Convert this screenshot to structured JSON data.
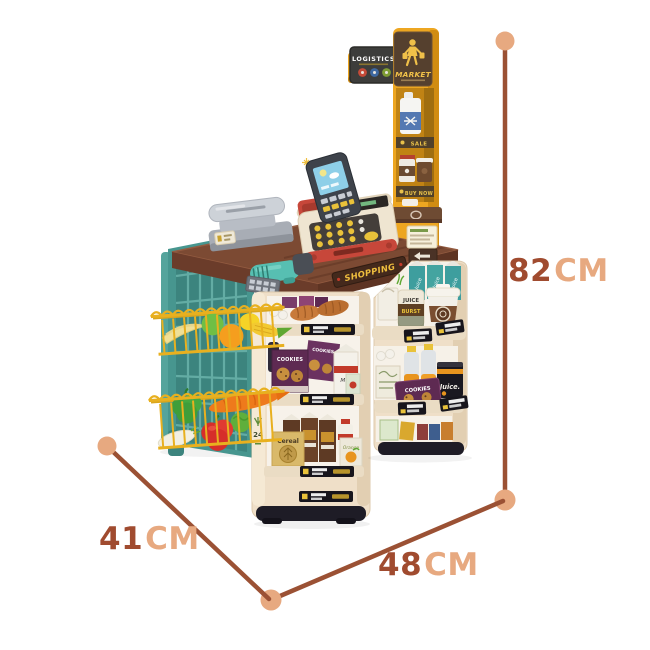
{
  "scene": {
    "type": "product-photo-with-dimension-annotations",
    "product_name": "toy-supermarket-checkout-playset",
    "background": "#ffffff"
  },
  "dimensions": {
    "height": {
      "value": "82",
      "unit": "CM"
    },
    "width": {
      "value": "48",
      "unit": "CM"
    },
    "depth": {
      "value": "41",
      "unit": "CM"
    }
  },
  "annotation": {
    "line_color": "#9b5134",
    "dot_color": "#e7a980",
    "value_color": "#a04b2f",
    "unit_color": "#e7a980"
  },
  "signs": {
    "market": "MARKET",
    "logistics": "LOGISTICS",
    "shopping": "SHOPPING",
    "sale": "SALE",
    "buy_now": "BUY NOW",
    "hours_badge": "24"
  },
  "products": {
    "cookies_box": "COOKIES",
    "cookies_bag": "COOKIES",
    "milk_carton": "Milk",
    "cereal_box": "Cereal",
    "juice_carton": "Juice",
    "juice_can_line1": "JUICE",
    "juice_can_line2": "BURST",
    "juice_black_can": "Juice.",
    "orange_box": "Orange"
  },
  "palette": {
    "pole_yellow": "#eda621",
    "sign_brown": "#55402e",
    "counter_brown": "#7c4a33",
    "shelf_cream": "#efdfc8",
    "panel_teal": "#47968f",
    "basket_yellow": "#e8b01f",
    "register_red": "#c7473a",
    "base_black": "#1e1c26"
  }
}
